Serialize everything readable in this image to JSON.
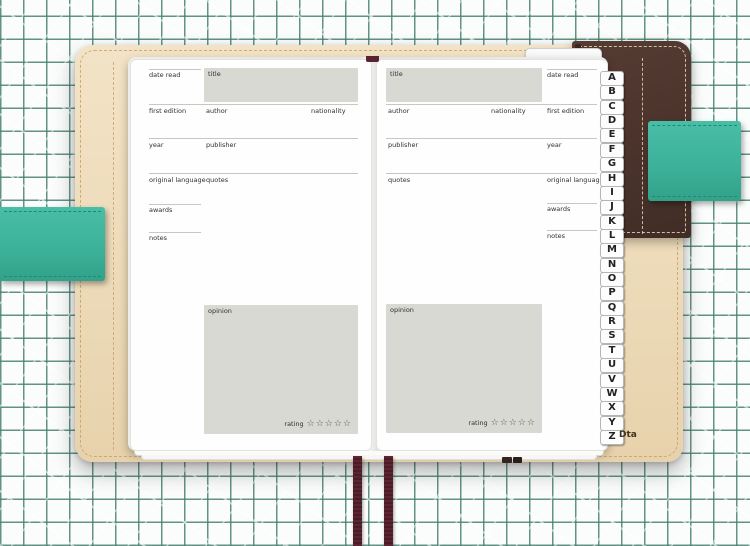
{
  "fields": {
    "date_read": "date read",
    "title": "title",
    "first_edition": "first edition",
    "author": "author",
    "nationality": "nationality",
    "year": "year",
    "publisher": "publisher",
    "original_language": "original language",
    "quotes": "quotes",
    "awards": "awards",
    "notes": "notes",
    "opinion": "opinion",
    "rating": "rating",
    "stars": "☆☆☆☆☆"
  },
  "index_tabs": {
    "letters": [
      "A",
      "B",
      "C",
      "D",
      "E",
      "F",
      "G",
      "H",
      "I",
      "J",
      "K",
      "L",
      "M",
      "N",
      "O",
      "P",
      "Q",
      "R",
      "S",
      "T",
      "U",
      "V",
      "W",
      "X",
      "Y",
      "Z"
    ]
  },
  "watermark": "Dta",
  "colors": {
    "grid_line": "#478070",
    "cover_brown": "#4b332c",
    "cover_cream": "#eedcbb",
    "strap_teal": "#3eb39c",
    "ribbon_burgundy": "#5a2330",
    "form_box_gray": "#d9d9d3"
  }
}
